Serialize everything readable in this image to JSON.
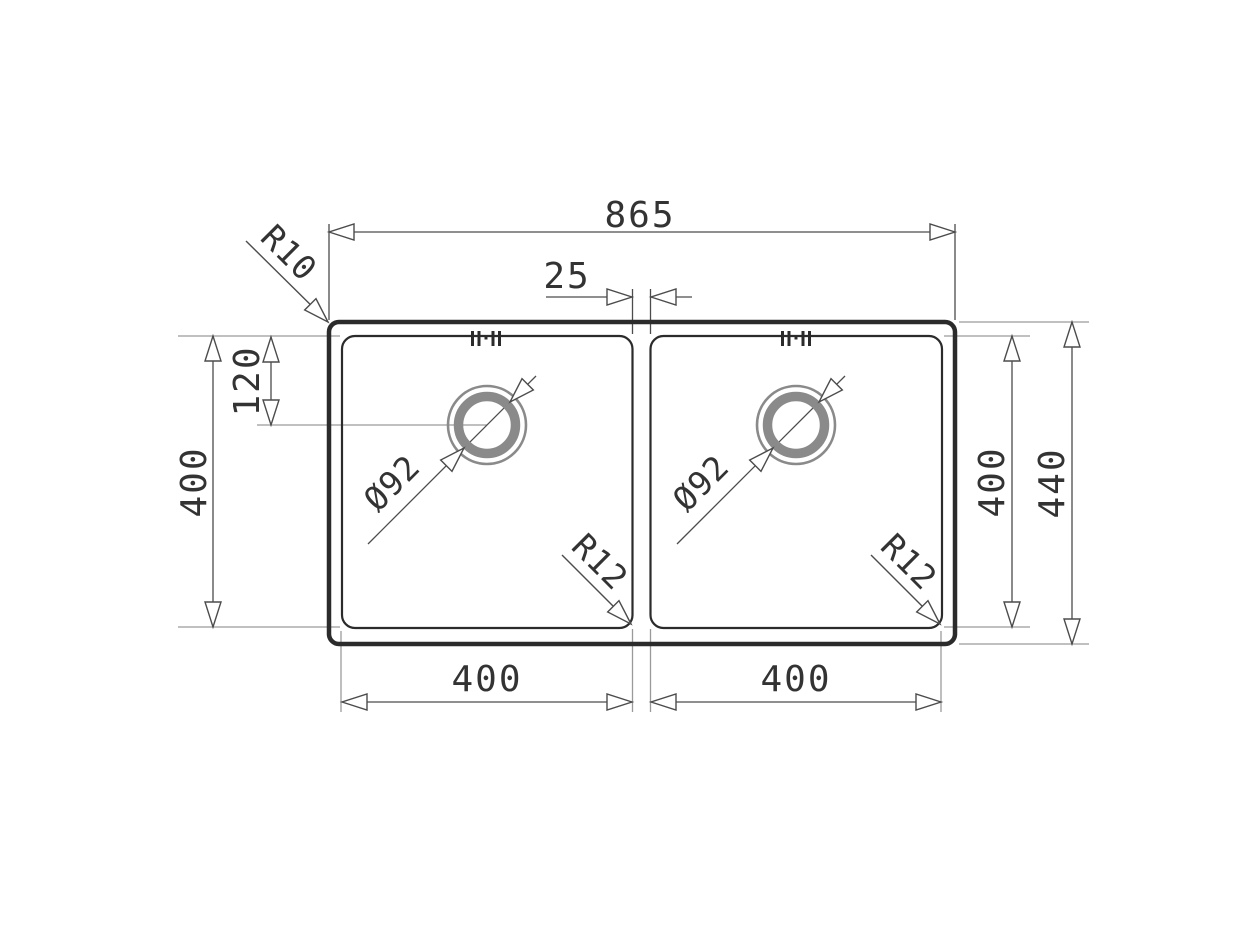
{
  "drawing": {
    "labels": {
      "overall_width": "865",
      "divider_width": "25",
      "drain_offset": "120",
      "bowl_depth_left": "400",
      "bowl_depth_right": "400",
      "overall_depth": "440",
      "bowl_width_left": "400",
      "bowl_width_right": "400",
      "corner_radius_outer": "R10",
      "corner_radius_bowl_left": "R12",
      "corner_radius_bowl_right": "R12",
      "drain_diameter_left": "Ø92",
      "drain_diameter_right": "Ø92"
    },
    "colors": {
      "outline_dark": "#2b2b2b",
      "dimension_line": "#4c4c4c",
      "extension_line": "#9a9a9a",
      "drain_ring_gray": "#8a8a8a",
      "text": "#333333",
      "background": "#ffffff"
    }
  }
}
